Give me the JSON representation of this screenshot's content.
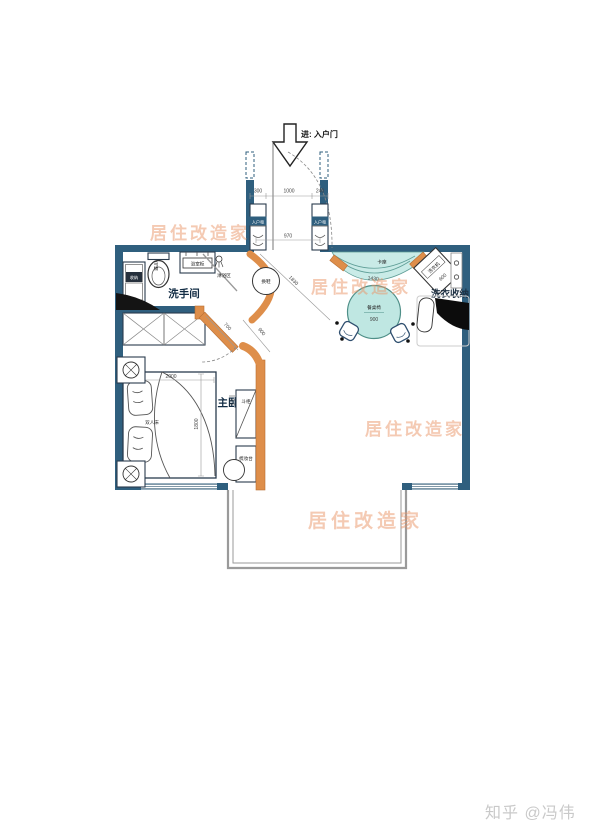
{
  "meta": {
    "watermark": "居住改造家",
    "credit": "知乎 @冯伟"
  },
  "colors": {
    "wall": "#2f5f7e",
    "accent_orange": "#de8e4a",
    "teal": "#c9ebe7",
    "watermark": "#eb9669"
  },
  "entry": {
    "door_label": "进: 入户门",
    "cabinet_left": "入户柜",
    "cabinet_right": "入户柜",
    "dim_left": "300",
    "dim_center": "1000",
    "dim_right": "240",
    "dim_width": "970",
    "dim_diagonal": "1830"
  },
  "bathroom": {
    "room_label": "洗手间",
    "toilet": "马桶",
    "vanity": "浴室柜",
    "shower": "淋浴区",
    "cabinet": "收纳"
  },
  "hallway": {
    "stool": "换鞋",
    "dim_door": "700",
    "dim_passage": "900"
  },
  "dining": {
    "booth": "卡座",
    "dim_booth": "1430",
    "table": "餐桌椅",
    "dim_table": "900"
  },
  "laundry": {
    "zone_label": "洗衣收纳",
    "washer": "洗衣机",
    "dim_washer": "600"
  },
  "bedroom": {
    "room_label": "主卧",
    "bed": "双人床",
    "dim_bed_width": "2000",
    "dim_bed_length": "1800",
    "chest": "斗柜",
    "dresser": "梳妆台"
  }
}
